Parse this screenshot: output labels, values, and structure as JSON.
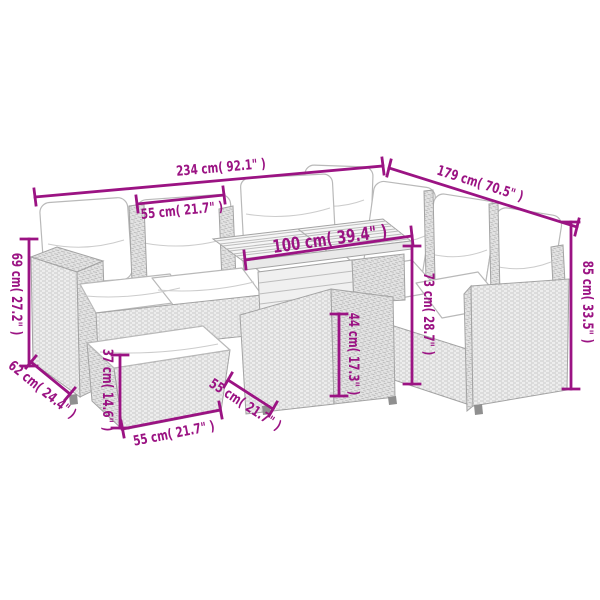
{
  "background": "#ffffff",
  "accent_color": "#9B1383",
  "diagram": {
    "subject": "L-shaped poly rattan garden lounge set with white cushions, slatted-top table and footstool, annotated with measurements"
  },
  "dims": [
    {
      "name": "total-width",
      "label": "234 cm( 92.1\" )"
    },
    {
      "name": "total-depth",
      "label": "179 cm( 70.5\" )"
    },
    {
      "name": "seat-width",
      "label": "55 cm( 21.7\" )"
    },
    {
      "name": "table-top-length",
      "label": "100 cm( 39.4\" )"
    },
    {
      "name": "total-height",
      "label": "85 cm( 33.5\" )"
    },
    {
      "name": "back-height",
      "label": "73 cm( 28.7\" )"
    },
    {
      "name": "table-height",
      "label": "44 cm( 17.3\" )"
    },
    {
      "name": "armrest-height",
      "label": "69 cm( 27.2\" )"
    },
    {
      "name": "armrest-depth",
      "label": "62 cm( 24.4\" )"
    },
    {
      "name": "ottoman-height",
      "label": "37 cm( 14.6\" )"
    },
    {
      "name": "ottoman-width",
      "label": "55 cm( 21.7\" )"
    },
    {
      "name": "ottoman-depth",
      "label": "55 cm( 21.7\" )"
    }
  ]
}
